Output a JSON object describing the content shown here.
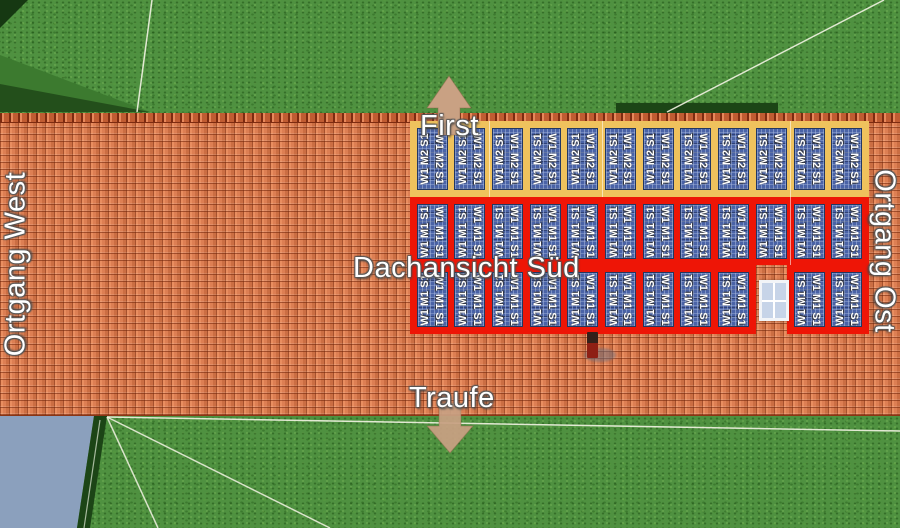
{
  "labels": {
    "ridge": "First",
    "eave": "Traufe",
    "verge_west": "Ortgang West",
    "verge_east": "Ortgang Ost",
    "roof_view": "Dachansicht Süd"
  },
  "panel_field": {
    "rows": [
      {
        "id": "row-first",
        "frame": "yellow",
        "panel_label": "W1 M2 S1",
        "groups": [
          {
            "start_col": 0,
            "count": 12
          }
        ]
      },
      {
        "id": "row-middle",
        "frame": "red",
        "panel_label": "W1 M1 S1",
        "groups": [
          {
            "start_col": 0,
            "count": 12
          }
        ]
      },
      {
        "id": "row-eave",
        "frame": "red",
        "panel_label": "W1 M1 S1",
        "groups": [
          {
            "start_col": 0,
            "count": 9
          },
          {
            "start_col": 10,
            "count": 2
          }
        ]
      }
    ],
    "total_panels": 35
  },
  "objects": {
    "roof_window": "roof-window",
    "vent": "vent-pipe"
  },
  "colors": {
    "grass": "#4f9140",
    "roof_tile": "#dd7f53",
    "frame_yellow": "#efc25d",
    "frame_red": "#ee1506",
    "panel_blue": "#4a63a7",
    "arrow_tan": "#c9a183",
    "wall_blue_gray": "#8ba0bd"
  }
}
